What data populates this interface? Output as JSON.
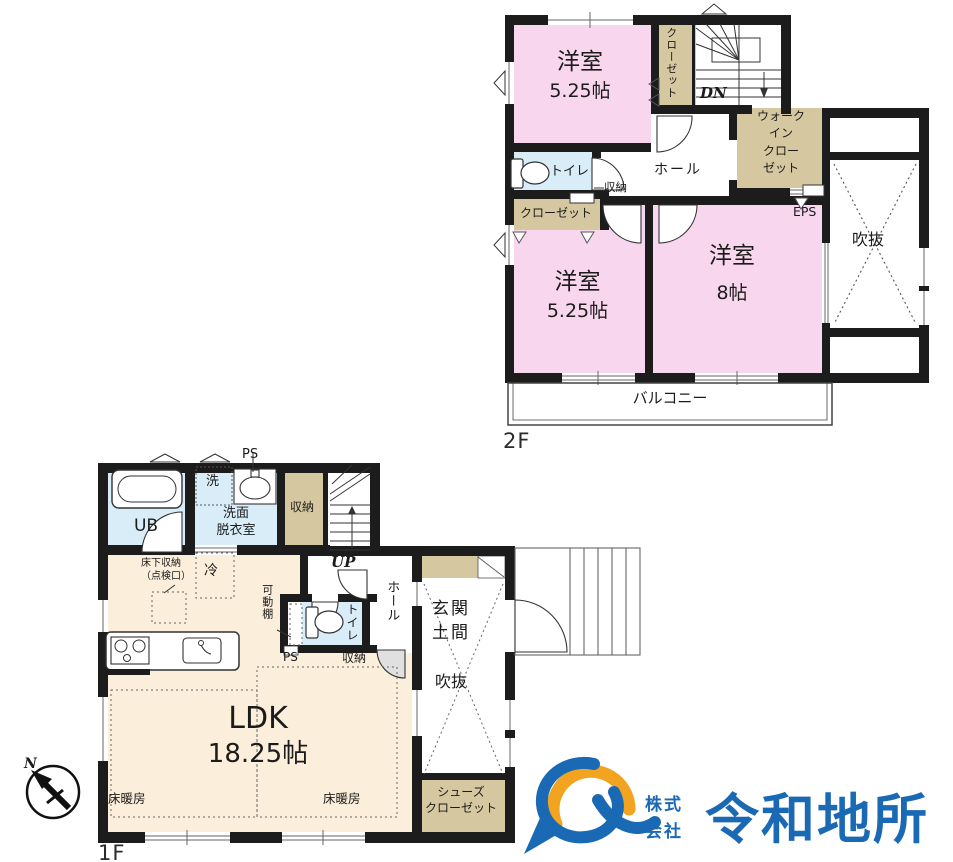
{
  "floor2": {
    "floor_label": "2F",
    "room_a_name": "洋室",
    "room_a_size": "5.25帖",
    "room_b_name": "洋室",
    "room_b_size": "5.25帖",
    "room_c_name": "洋室",
    "room_c_size": "8帖",
    "closet_top": "クローゼット",
    "closet_left": "クローゼット",
    "walkin_closet": "ウォーク\nイン\nクロー\nゼット",
    "toilet": "トイレ",
    "hall": "ホール",
    "storage": "収納",
    "stairs_down": "DN",
    "eps": "EPS",
    "void": "吹抜",
    "balcony": "バルコニー"
  },
  "floor1": {
    "floor_label": "1F",
    "unit_bath": "UB",
    "washer": "洗",
    "washroom": "洗面\n脱衣室",
    "pipe_space_top": "PS",
    "storage_top": "収納",
    "stairs_up": "UP",
    "underfloor_storage": "床下収納\n（点検口）",
    "fridge": "冷",
    "movable_shelf": "可動棚",
    "toilet": "トイレ",
    "pipe_space_mid": "PS",
    "storage_mid": "収納",
    "hall": "ホール",
    "entrance": "玄関\n土間",
    "void": "吹抜",
    "ldk_name": "LDK",
    "ldk_size": "18.25帖",
    "floor_heating": "床暖房",
    "shoes_closet": "シューズ\nクローゼット"
  },
  "compass": {
    "north": "N"
  },
  "logo": {
    "company_prefix": "株式\n会社",
    "company_name": "令和地所",
    "brand_blue": "#1a69b4",
    "brand_gold": "#f2a31f"
  },
  "colors": {
    "room_pink": "#f8d7ee",
    "closet_tan": "#d5c79f",
    "wet_blue": "#d9edf8",
    "ldk_cream": "#fbeeda",
    "wall": "#1c1c1c"
  }
}
